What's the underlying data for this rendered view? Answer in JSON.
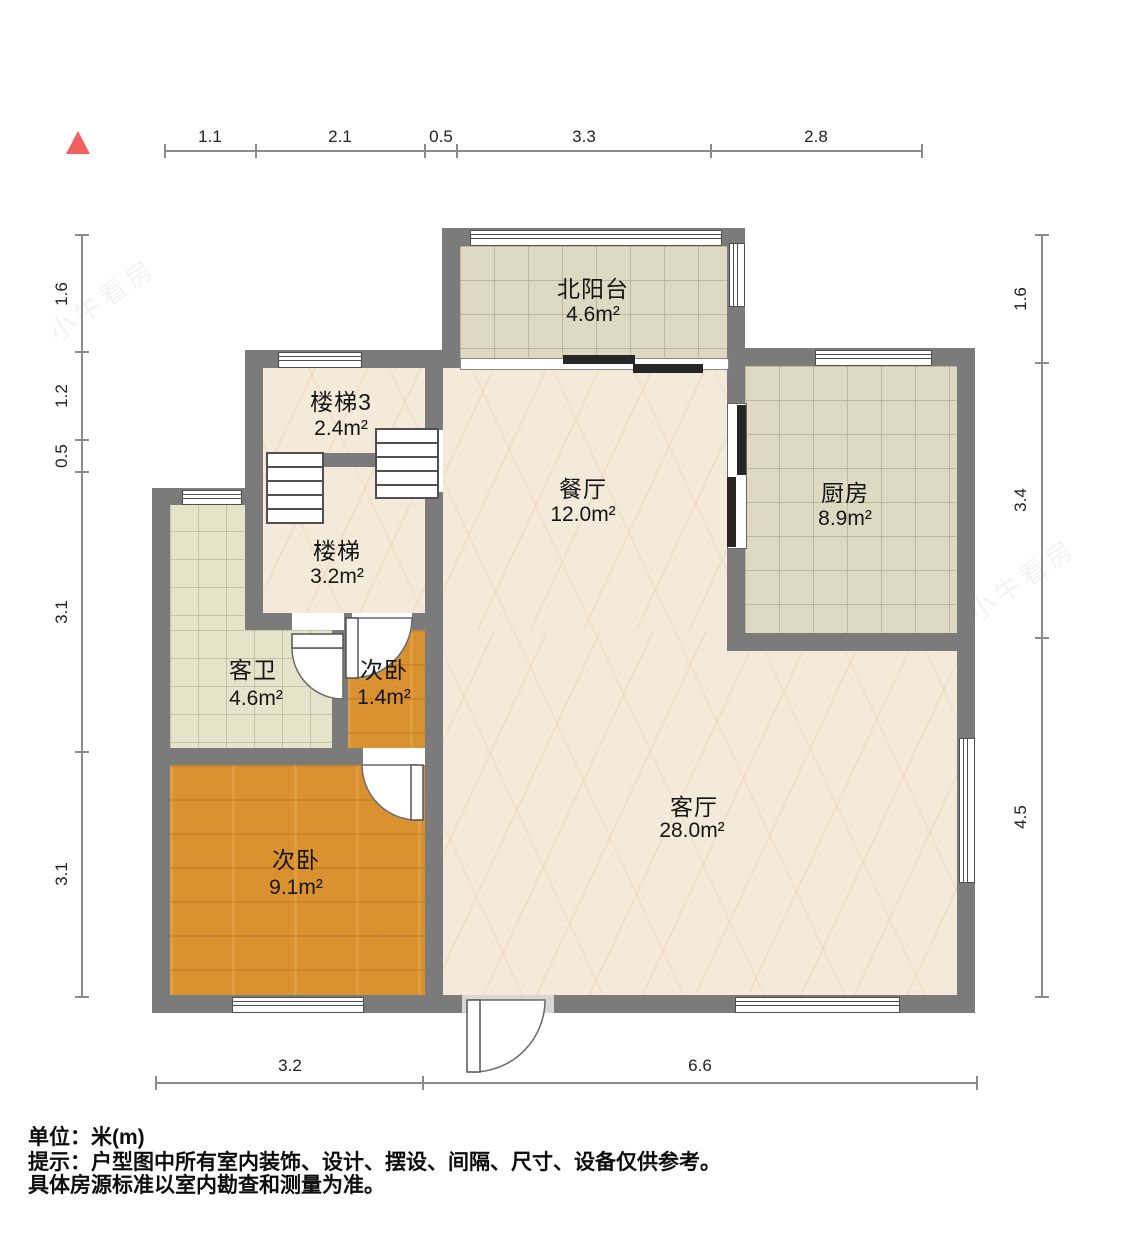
{
  "rooms": {
    "balcony": {
      "name": "北阳台",
      "area": "4.6m²"
    },
    "stairs3": {
      "name": "楼梯3",
      "area": "2.4m²"
    },
    "dining": {
      "name": "餐厅",
      "area": "12.0m²"
    },
    "kitchen": {
      "name": "厨房",
      "area": "8.9m²"
    },
    "stairs": {
      "name": "楼梯",
      "area": "3.2m²"
    },
    "bath": {
      "name": "客卫",
      "area": "4.6m²"
    },
    "bed_small": {
      "name": "次卧",
      "area": "1.4m²"
    },
    "bed9": {
      "name": "次卧",
      "area": "9.1m²"
    },
    "living": {
      "name": "客厅",
      "area": "28.0m²"
    }
  },
  "dims": {
    "top": [
      "1.1",
      "2.1",
      "0.5",
      "3.3",
      "2.8"
    ],
    "left": [
      "1.6",
      "1.2",
      "0.5",
      "3.1",
      "3.1"
    ],
    "right": [
      "1.6",
      "3.4",
      "4.5"
    ],
    "bottom": [
      "3.2",
      "6.6"
    ]
  },
  "footer": {
    "unit": "单位：米(m)",
    "note1": "提示：户型图中所有室内装饰、设计、摆设、间隔、尺寸、设备仅供参考。",
    "note2": "具体房源标准以室内勘查和测量为准。"
  },
  "watermark": {
    "text": "小牛看房"
  },
  "colors": {
    "wall": "#7b7b7b",
    "marble_floor": "#f3ead9",
    "tile_floor": "#ded9c2",
    "bath_tile_floor": "#e3e4ca",
    "wood_floor": "#da9231",
    "north_arrow": "#f15f5f",
    "dim_line": "#8a8a8a"
  }
}
